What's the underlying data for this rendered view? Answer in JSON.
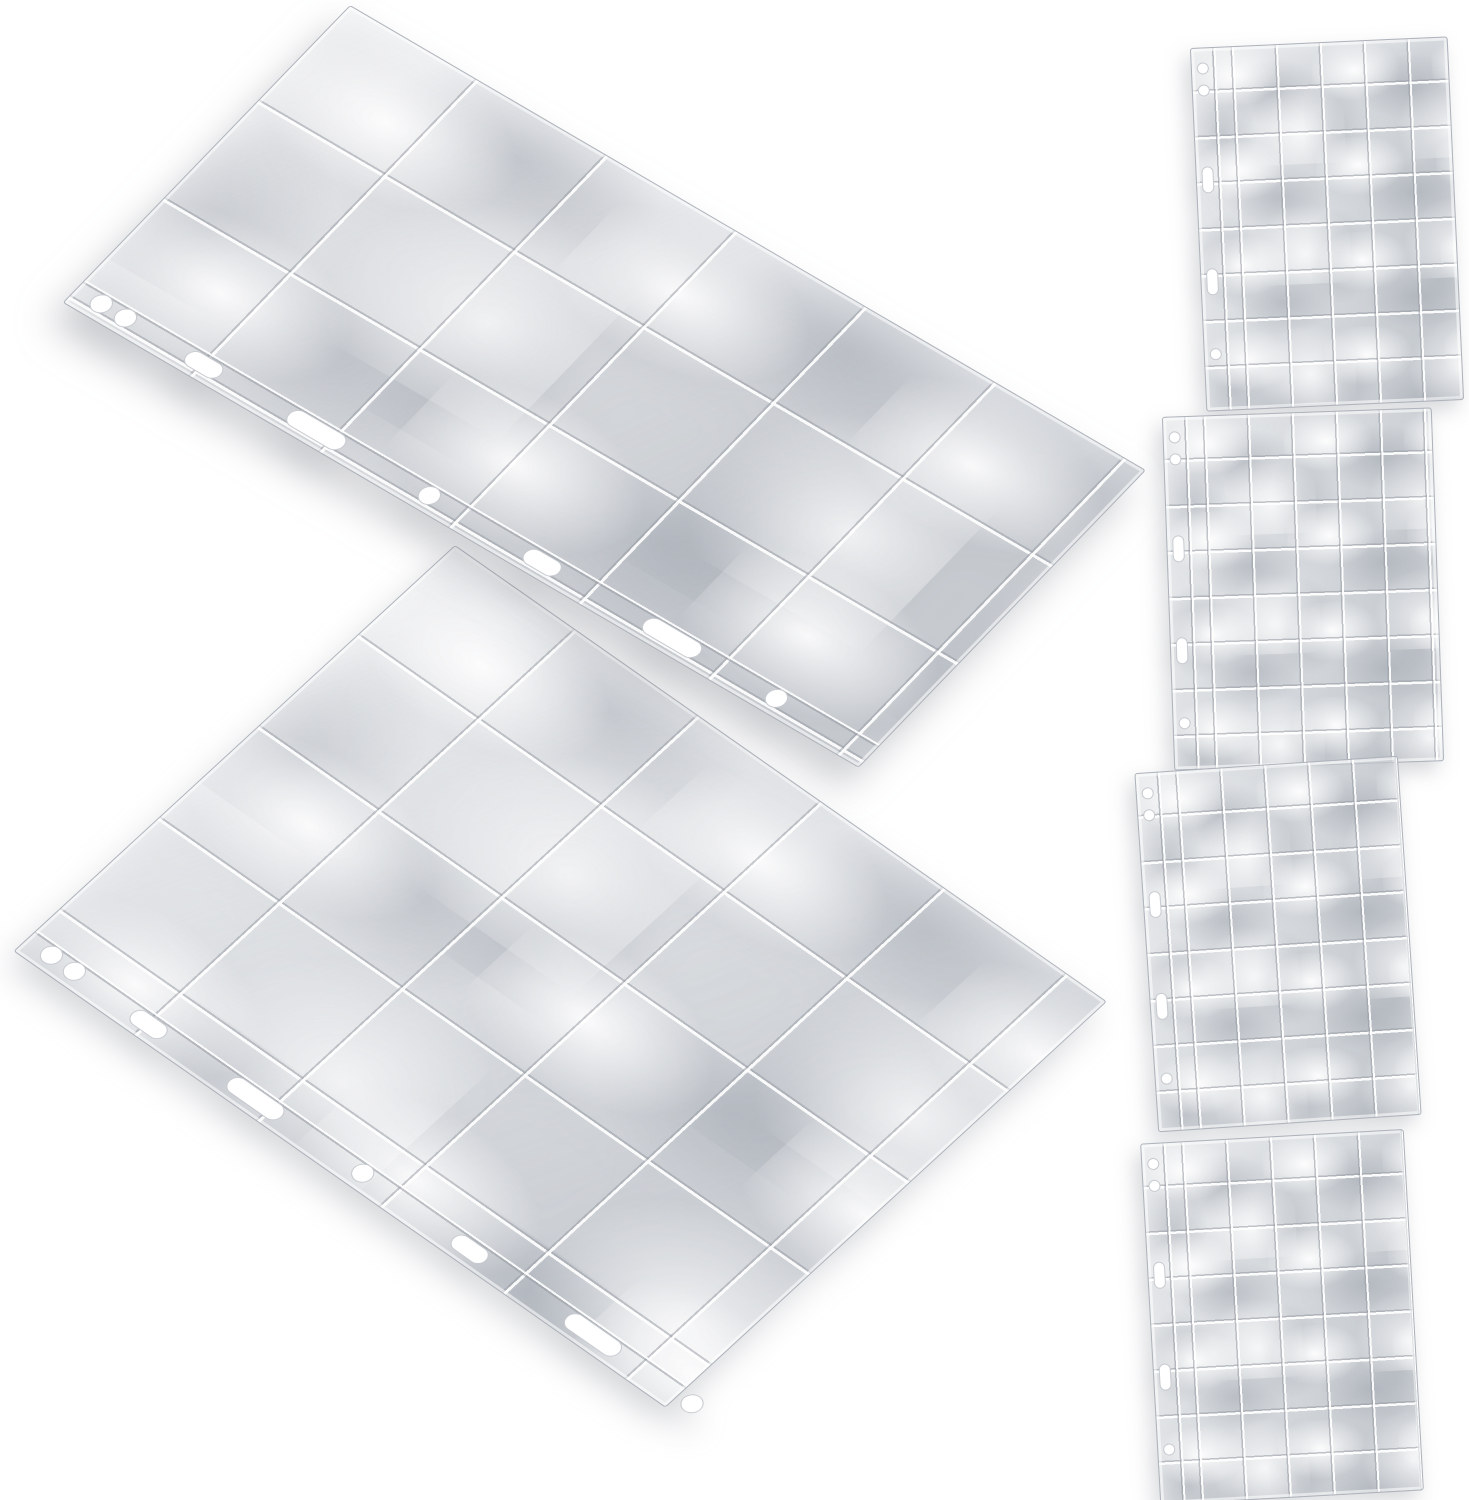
{
  "scene": {
    "background_color": "#ffffff",
    "description": "Product photo of six clear plastic multi-pocket binder pages on a plain white background: two large pocket pages fanned diagonally on the left, four small pocket pages in a vertical column on the right",
    "colors": {
      "background": "#ffffff",
      "plastic-base": "#d2d6db",
      "grid-line": "#9499a1",
      "highlight": "#ffffff",
      "edge-line": "#aeb3bb",
      "shadow": "#878c94"
    },
    "large_pages": {
      "count": 2,
      "pocket_columns": 6,
      "pocket_rows": 3,
      "binder_holes": 8,
      "material": "transparent plastic"
    },
    "small_pages": {
      "count": 4,
      "pocket_columns": 6,
      "pocket_rows": 8,
      "binder_holes": 5,
      "material": "transparent plastic"
    },
    "a11y": {
      "photo": "Product photo of transparent pocket binder pages",
      "large_page_1": "Large clear multi-pocket binder page, upper left",
      "large_page_2": "Large clear multi-pocket binder page, lower left",
      "small_page_1": "Small clear multi-pocket binder page, first in right column",
      "small_page_2": "Small clear multi-pocket binder page, second in right column",
      "small_page_3": "Small clear multi-pocket binder page, third in right column",
      "small_page_4": "Small clear multi-pocket binder page, fourth in right column"
    }
  }
}
